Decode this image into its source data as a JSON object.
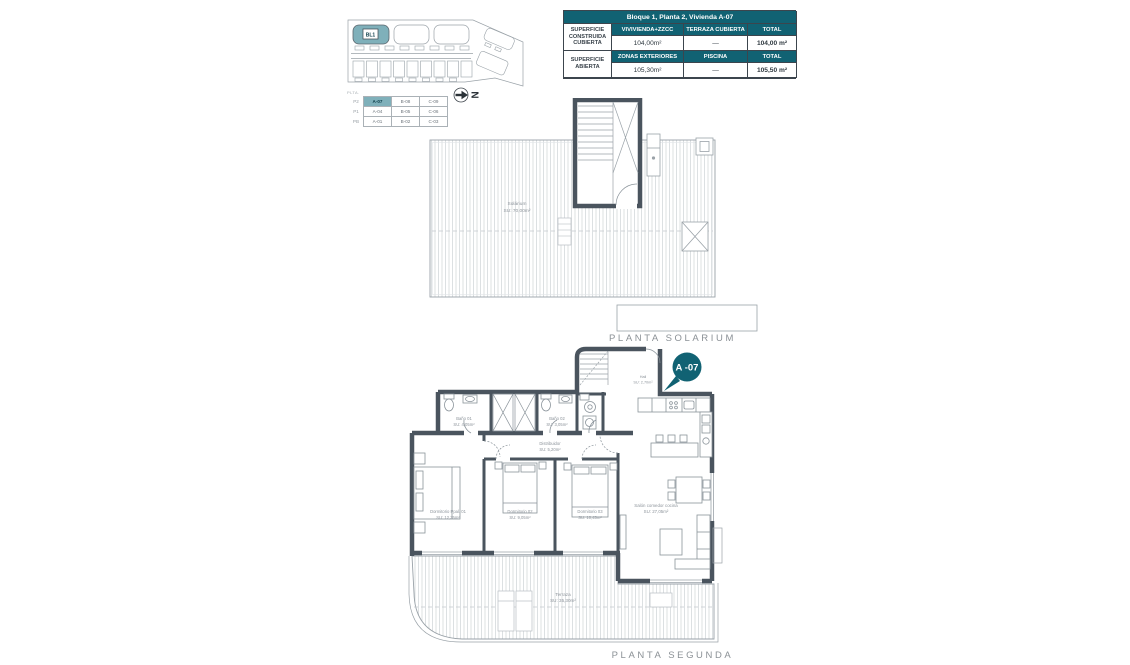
{
  "colors": {
    "teal": "#116273",
    "teal-light": "#7fb0ba",
    "wall": "#4a545e",
    "outline": "#9aa2a8",
    "hatch": "#d4d8db",
    "labelc": "#8d949b",
    "caption": "#8b9196"
  },
  "summary_table": {
    "title": "Bloque 1, Planta 2, Vivienda A-07",
    "group1": {
      "label": "SUPERFICIE CONSTRUIDA CUBIERTA",
      "headers": [
        "VIVIVIENDA+ZZCC",
        "TERRAZA CUBIERTA",
        "TOTAL"
      ],
      "values": [
        "104,00m²",
        "—",
        "104,00 m²"
      ]
    },
    "group2": {
      "label": "SUPERFICIE ABIERTA",
      "headers": [
        "ZONAS EXTERIORES",
        "PISCINA",
        "TOTAL"
      ],
      "values": [
        "105,30m²",
        "—",
        "105,50 m²"
      ]
    }
  },
  "site_plan": {
    "block_label": "BL1"
  },
  "key_table": {
    "caption": "PLTA.",
    "rows": [
      {
        "level": "P2",
        "units": [
          "A-07",
          "B-08",
          "C-09"
        ]
      },
      {
        "level": "P1",
        "units": [
          "A-04",
          "B-05",
          "C-06"
        ]
      },
      {
        "level": "PB",
        "units": [
          "A-01",
          "B-02",
          "C-03"
        ]
      }
    ]
  },
  "north": {
    "letter": "N"
  },
  "solarium": {
    "caption": "PLANTA SOLARIUM",
    "room": {
      "name": "Solárium",
      "area": "SU: 70,00m²"
    }
  },
  "segunda": {
    "caption": "PLANTA SEGUNDA",
    "badge": "A -07",
    "rooms": {
      "hall": {
        "name": "Hall",
        "area": "SU: 2,70m²"
      },
      "bano1": {
        "name": "Baño 01",
        "area": "SU: 4,05m²"
      },
      "bano2": {
        "name": "Baño 02",
        "area": "SU: 3,05m²"
      },
      "distribuidor": {
        "name": "Distribuidor",
        "area": "SU: 5,20m²"
      },
      "dorm1": {
        "name": "Dormitorio Ppal. 01",
        "area": "SU: 12,35m²"
      },
      "dorm2": {
        "name": "Dormitorio 02",
        "area": "SU: 9,05m²"
      },
      "dorm3": {
        "name": "Dormitorio 03",
        "area": "SU: 10,45m²"
      },
      "salon": {
        "name": "Salón comedor cocina",
        "area": "SU: 27,05m²"
      },
      "terraza": {
        "name": "Terraza",
        "area": "SU: 35,30m²"
      }
    }
  }
}
